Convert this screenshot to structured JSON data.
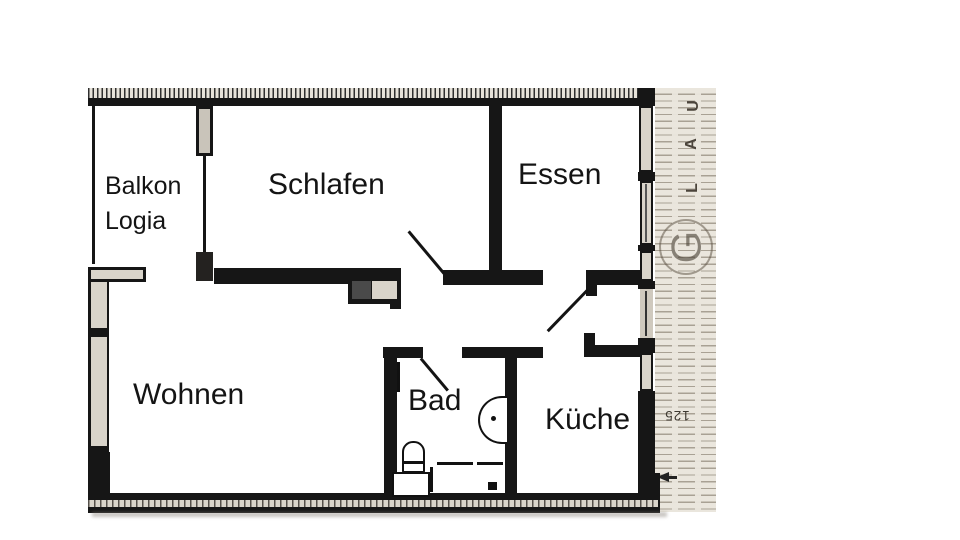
{
  "rooms": [
    {
      "name": "balkon",
      "label": "Balkon",
      "label2": "Logia"
    },
    {
      "name": "schlafen",
      "label": "Schlafen"
    },
    {
      "name": "essen",
      "label": "Essen"
    },
    {
      "name": "wohnen",
      "label": "Wohnen"
    },
    {
      "name": "bad",
      "label": "Bad"
    },
    {
      "name": "kueche",
      "label": "Küche"
    }
  ],
  "gallery": {
    "letters": [
      "U",
      "A",
      "L"
    ],
    "stamp_letter": "G",
    "dimension": "125"
  },
  "colors": {
    "wall": "#161616",
    "window_fill": "#d9d4ca",
    "gallery_background": "#eae6dd",
    "gallery_line": "#7d7364",
    "label_text": "#141414"
  }
}
